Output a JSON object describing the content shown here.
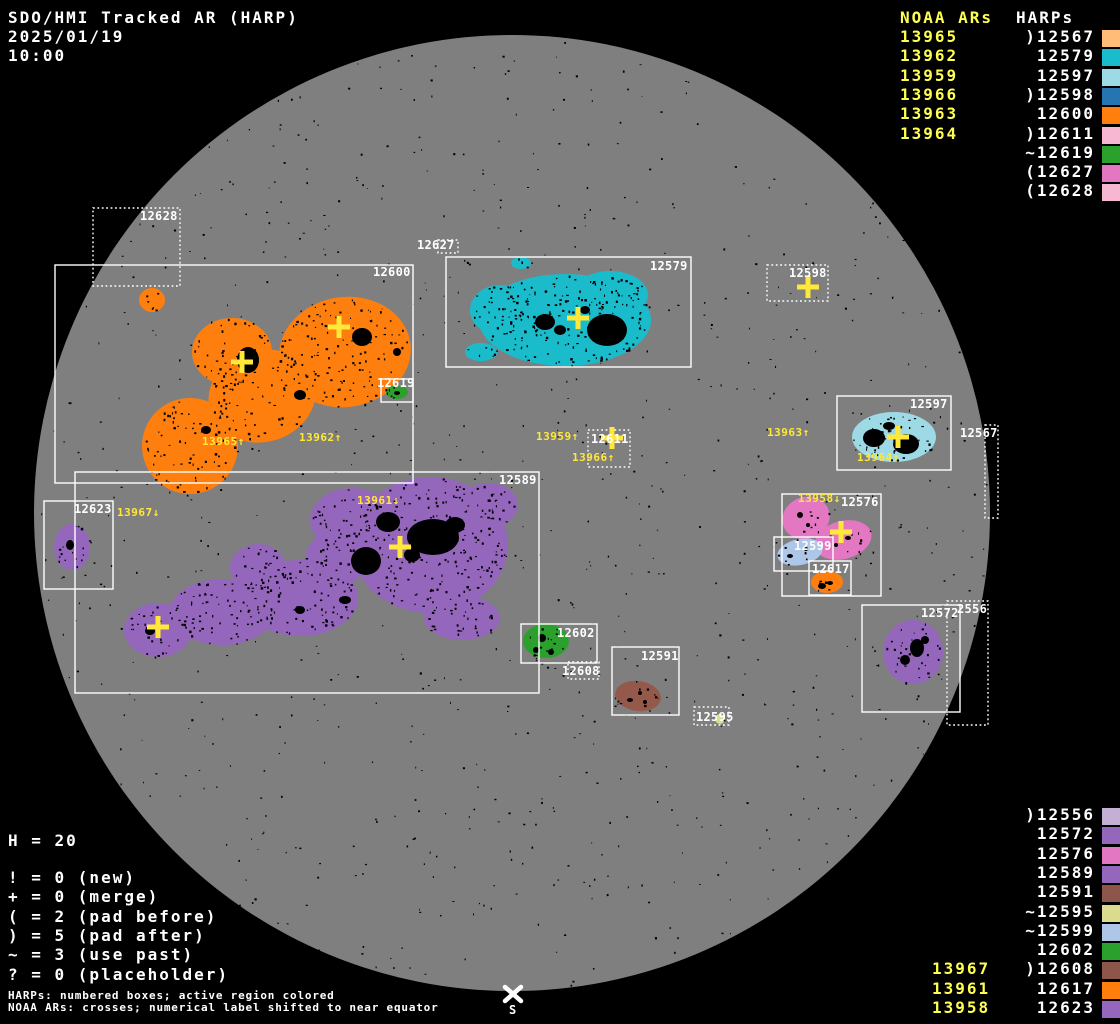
{
  "title": {
    "line1": "SDO/HMI Tracked AR (HARP)",
    "date": "2025/01/19",
    "time": "10:00"
  },
  "colors": {
    "background": "#000000",
    "disk": "#7f7f7f",
    "speckle": "#000000",
    "box_stroke": "#ffffff",
    "noaa_list_text": "#ffff52",
    "noaa_marker": "#ffe83a",
    "white_text": "#ffffff"
  },
  "disk": {
    "cx": 512,
    "cy": 513,
    "r": 478,
    "south_label": "S"
  },
  "top_right_panel": {
    "noaa_header": "NOAA ARs",
    "harps_header": "HARPs",
    "noaa_items": [
      "13965",
      "13962",
      "13959",
      "13966",
      "13963",
      "13964"
    ],
    "harp_items": [
      {
        "prefix": ")",
        "number": "12567",
        "color": "#ffbb78"
      },
      {
        "prefix": " ",
        "number": "12579",
        "color": "#1abccc"
      },
      {
        "prefix": " ",
        "number": "12597",
        "color": "#9edae5"
      },
      {
        "prefix": ")",
        "number": "12598",
        "color": "#2575b2"
      },
      {
        "prefix": " ",
        "number": "12600",
        "color": "#ff7f0e"
      },
      {
        "prefix": ")",
        "number": "12611",
        "color": "#f7b6d2"
      },
      {
        "prefix": "~",
        "number": "12619",
        "color": "#2ca02c"
      },
      {
        "prefix": "(",
        "number": "12627",
        "color": "#e377c2"
      },
      {
        "prefix": "(",
        "number": "12628",
        "color": "#f7b6d2"
      }
    ]
  },
  "bottom_right_panel": {
    "noaa_items": [
      "13967",
      "13961",
      "13958"
    ],
    "harp_items": [
      {
        "prefix": ")",
        "number": "12556",
        "color": "#c5b0d5"
      },
      {
        "prefix": " ",
        "number": "12572",
        "color": "#9467bd"
      },
      {
        "prefix": " ",
        "number": "12576",
        "color": "#e377c2"
      },
      {
        "prefix": " ",
        "number": "12589",
        "color": "#9467bd"
      },
      {
        "prefix": " ",
        "number": "12591",
        "color": "#8c564b"
      },
      {
        "prefix": "~",
        "number": "12595",
        "color": "#dbdb8d"
      },
      {
        "prefix": "~",
        "number": "12599",
        "color": "#aec7e8"
      },
      {
        "prefix": " ",
        "number": "12602",
        "color": "#2ca02c"
      },
      {
        "prefix": ")",
        "number": "12608",
        "color": "#8c564b"
      },
      {
        "prefix": " ",
        "number": "12617",
        "color": "#ff7f0e"
      },
      {
        "prefix": " ",
        "number": "12623",
        "color": "#9467bd"
      }
    ]
  },
  "legend": {
    "h_count": "H = 20",
    "lines": [
      "! = 0 (new)",
      "+ = 0 (merge)",
      "( = 2 (pad before)",
      ") = 5 (pad after)",
      "~ = 3 (use past)",
      "? = 0 (placeholder)"
    ]
  },
  "footer": {
    "line1": "HARPs: numbered boxes; active region colored",
    "line2": "NOAA ARs: crosses; numerical label shifted to near equator"
  },
  "chart_data": {
    "type": "scatter",
    "title": "SDO/HMI Tracked AR (HARP)",
    "datetime": "2025/01/19 10:00",
    "harp_count": 20,
    "harp_boxes": [
      {
        "harp": "12628",
        "label": "12628",
        "style": "dotted",
        "x": 93,
        "y": 208,
        "w": 87,
        "h": 78,
        "label_x": 140,
        "label_y": 210
      },
      {
        "harp": "12600",
        "label": "12600",
        "style": "solid",
        "x": 55,
        "y": 265,
        "w": 358,
        "h": 218,
        "label_x": 373,
        "label_y": 266
      },
      {
        "harp": "12627",
        "label": "12627",
        "style": "dotted",
        "x": 438,
        "y": 240,
        "w": 20,
        "h": 13,
        "label_x": 417,
        "label_y": 239
      },
      {
        "harp": "12579",
        "label": "12579",
        "style": "solid",
        "x": 446,
        "y": 257,
        "w": 245,
        "h": 110,
        "label_x": 650,
        "label_y": 260
      },
      {
        "harp": "12598",
        "label": "12598",
        "style": "dotted",
        "x": 767,
        "y": 265,
        "w": 61,
        "h": 36,
        "label_x": 789,
        "label_y": 267
      },
      {
        "harp": "12619",
        "label": "12619",
        "style": "solid",
        "x": 381,
        "y": 379,
        "w": 32,
        "h": 23,
        "label_x": 377,
        "label_y": 377
      },
      {
        "harp": "12597",
        "label": "12597",
        "style": "solid",
        "x": 837,
        "y": 396,
        "w": 114,
        "h": 74,
        "label_x": 910,
        "label_y": 398
      },
      {
        "harp": "12567",
        "label": "12567",
        "style": "dotted",
        "x": 985,
        "y": 425,
        "w": 13,
        "h": 93,
        "label_x": 960,
        "label_y": 427
      },
      {
        "harp": "12611",
        "label": "12611",
        "style": "dotted",
        "x": 588,
        "y": 430,
        "w": 42,
        "h": 37,
        "label_x": 591,
        "label_y": 433
      },
      {
        "harp": "12589",
        "label": "12589",
        "style": "solid",
        "x": 75,
        "y": 472,
        "w": 464,
        "h": 221,
        "label_x": 499,
        "label_y": 474
      },
      {
        "harp": "12623",
        "label": "12623",
        "style": "solid",
        "x": 44,
        "y": 501,
        "w": 69,
        "h": 88,
        "label_x": 74,
        "label_y": 503
      },
      {
        "harp": "12576",
        "label": "12576",
        "style": "solid",
        "x": 782,
        "y": 494,
        "w": 99,
        "h": 102,
        "label_x": 841,
        "label_y": 496
      },
      {
        "harp": "12599",
        "label": "12599",
        "style": "solid",
        "x": 774,
        "y": 537,
        "w": 59,
        "h": 34,
        "label_x": 794,
        "label_y": 540
      },
      {
        "harp": "12617",
        "label": "12617",
        "style": "solid",
        "x": 809,
        "y": 561,
        "w": 42,
        "h": 34,
        "label_x": 812,
        "label_y": 563
      },
      {
        "harp": "12556",
        "label": "2556",
        "style": "dotted",
        "x": 947,
        "y": 601,
        "w": 41,
        "h": 124,
        "label_x": 957,
        "label_y": 603
      },
      {
        "harp": "12572",
        "label": "12572",
        "style": "solid",
        "x": 862,
        "y": 605,
        "w": 98,
        "h": 107,
        "label_x": 921,
        "label_y": 607
      },
      {
        "harp": "12602",
        "label": "12602",
        "style": "solid",
        "x": 521,
        "y": 624,
        "w": 76,
        "h": 39,
        "label_x": 557,
        "label_y": 627
      },
      {
        "harp": "12591",
        "label": "12591",
        "style": "solid",
        "x": 612,
        "y": 647,
        "w": 67,
        "h": 68,
        "label_x": 641,
        "label_y": 650
      },
      {
        "harp": "12608",
        "label": "12608",
        "style": "dotted",
        "x": 568,
        "y": 662,
        "w": 31,
        "h": 17,
        "label_x": 562,
        "label_y": 665
      },
      {
        "harp": "12595",
        "label": "12595",
        "style": "dotted",
        "x": 694,
        "y": 707,
        "w": 35,
        "h": 18,
        "label_x": 696,
        "label_y": 711
      }
    ],
    "noaa_crosses": [
      {
        "x": 242,
        "y": 362
      },
      {
        "x": 339,
        "y": 327
      },
      {
        "x": 578,
        "y": 318
      },
      {
        "x": 612,
        "y": 438
      },
      {
        "x": 808,
        "y": 287
      },
      {
        "x": 898,
        "y": 437
      },
      {
        "x": 841,
        "y": 532
      },
      {
        "x": 400,
        "y": 547
      },
      {
        "x": 158,
        "y": 627
      }
    ],
    "noaa_labels": [
      {
        "text": "13965↑",
        "x": 202,
        "y": 436
      },
      {
        "text": "13962↑",
        "x": 299,
        "y": 432
      },
      {
        "text": "13959↑",
        "x": 536,
        "y": 431
      },
      {
        "text": "13966↑",
        "x": 572,
        "y": 452
      },
      {
        "text": "13963↑",
        "x": 767,
        "y": 427
      },
      {
        "text": "13964↑",
        "x": 857,
        "y": 452
      },
      {
        "text": "13958↓",
        "x": 798,
        "y": 493
      },
      {
        "text": "13961↓",
        "x": 357,
        "y": 495
      },
      {
        "text": "13967↓",
        "x": 117,
        "y": 507
      }
    ]
  },
  "shapes": [
    {
      "harp": "12600",
      "color": "#ff7f0e",
      "speckles": 300,
      "blobs": [
        {
          "cx": 345,
          "cy": 352,
          "rx": 66,
          "ry": 55,
          "rot": -8
        },
        {
          "cx": 262,
          "cy": 396,
          "rx": 54,
          "ry": 46,
          "rot": -15
        },
        {
          "cx": 190,
          "cy": 446,
          "rx": 48,
          "ry": 48,
          "rot": 0
        },
        {
          "cx": 232,
          "cy": 352,
          "rx": 40,
          "ry": 34,
          "rot": 0
        },
        {
          "cx": 152,
          "cy": 300,
          "rx": 13,
          "ry": 12,
          "rot": 0
        }
      ],
      "spots": [
        {
          "cx": 248,
          "cy": 360,
          "rx": 11,
          "ry": 13
        },
        {
          "cx": 362,
          "cy": 337,
          "rx": 10,
          "ry": 9
        },
        {
          "cx": 300,
          "cy": 395,
          "rx": 6,
          "ry": 5
        },
        {
          "cx": 206,
          "cy": 430,
          "rx": 5,
          "ry": 4
        },
        {
          "cx": 397,
          "cy": 352,
          "rx": 4,
          "ry": 4
        }
      ]
    },
    {
      "harp": "12579",
      "color": "#1abccc",
      "speckles": 240,
      "blobs": [
        {
          "cx": 565,
          "cy": 320,
          "rx": 86,
          "ry": 46,
          "rot": 0
        },
        {
          "cx": 610,
          "cy": 295,
          "rx": 38,
          "ry": 24,
          "rot": 0
        },
        {
          "cx": 500,
          "cy": 310,
          "rx": 30,
          "ry": 25,
          "rot": 0
        },
        {
          "cx": 521,
          "cy": 263,
          "rx": 10,
          "ry": 6,
          "rot": 0
        },
        {
          "cx": 481,
          "cy": 352,
          "rx": 16,
          "ry": 9,
          "rot": 0
        }
      ],
      "spots": [
        {
          "cx": 607,
          "cy": 330,
          "rx": 20,
          "ry": 16
        },
        {
          "cx": 545,
          "cy": 322,
          "rx": 10,
          "ry": 8
        },
        {
          "cx": 560,
          "cy": 330,
          "rx": 6,
          "ry": 5
        },
        {
          "cx": 585,
          "cy": 310,
          "rx": 5,
          "ry": 4
        }
      ]
    },
    {
      "harp": "12597",
      "color": "#9edae5",
      "speckles": 45,
      "blobs": [
        {
          "cx": 894,
          "cy": 437,
          "rx": 42,
          "ry": 25,
          "rot": 0
        }
      ],
      "spots": [
        {
          "cx": 874,
          "cy": 438,
          "rx": 11,
          "ry": 9
        },
        {
          "cx": 906,
          "cy": 444,
          "rx": 13,
          "ry": 10
        },
        {
          "cx": 889,
          "cy": 426,
          "rx": 6,
          "ry": 4
        }
      ]
    },
    {
      "harp": "12589",
      "color": "#9467bd",
      "speckles": 520,
      "blobs": [
        {
          "cx": 430,
          "cy": 545,
          "rx": 78,
          "ry": 68,
          "rot": 0
        },
        {
          "cx": 352,
          "cy": 520,
          "rx": 42,
          "ry": 32,
          "rot": 0
        },
        {
          "cx": 300,
          "cy": 598,
          "rx": 58,
          "ry": 38,
          "rot": 0
        },
        {
          "cx": 222,
          "cy": 612,
          "rx": 52,
          "ry": 33,
          "rot": 0
        },
        {
          "cx": 158,
          "cy": 630,
          "rx": 34,
          "ry": 27,
          "rot": 0
        },
        {
          "cx": 258,
          "cy": 568,
          "rx": 28,
          "ry": 24,
          "rot": 0
        },
        {
          "cx": 462,
          "cy": 618,
          "rx": 38,
          "ry": 22,
          "rot": 0
        },
        {
          "cx": 335,
          "cy": 560,
          "rx": 30,
          "ry": 28,
          "rot": 0
        },
        {
          "cx": 488,
          "cy": 505,
          "rx": 30,
          "ry": 22,
          "rot": 0
        }
      ],
      "spots": [
        {
          "cx": 433,
          "cy": 537,
          "rx": 26,
          "ry": 18
        },
        {
          "cx": 366,
          "cy": 561,
          "rx": 15,
          "ry": 14
        },
        {
          "cx": 388,
          "cy": 522,
          "rx": 12,
          "ry": 10
        },
        {
          "cx": 455,
          "cy": 525,
          "rx": 10,
          "ry": 8
        },
        {
          "cx": 412,
          "cy": 555,
          "rx": 8,
          "ry": 7
        },
        {
          "cx": 150,
          "cy": 631,
          "rx": 5,
          "ry": 4
        },
        {
          "cx": 345,
          "cy": 600,
          "rx": 6,
          "ry": 4
        },
        {
          "cx": 300,
          "cy": 610,
          "rx": 5,
          "ry": 4
        }
      ]
    },
    {
      "harp": "12623",
      "color": "#9467bd",
      "speckles": 14,
      "blobs": [
        {
          "cx": 72,
          "cy": 547,
          "rx": 18,
          "ry": 23,
          "rot": 0
        }
      ],
      "spots": [
        {
          "cx": 70,
          "cy": 545,
          "rx": 4,
          "ry": 5
        }
      ]
    },
    {
      "harp": "12572",
      "color": "#9467bd",
      "speckles": 25,
      "blobs": [
        {
          "cx": 913,
          "cy": 652,
          "rx": 30,
          "ry": 32,
          "rot": 0
        }
      ],
      "spots": [
        {
          "cx": 917,
          "cy": 648,
          "rx": 7,
          "ry": 9
        },
        {
          "cx": 905,
          "cy": 660,
          "rx": 5,
          "ry": 5
        },
        {
          "cx": 925,
          "cy": 640,
          "rx": 4,
          "ry": 4
        }
      ]
    },
    {
      "harp": "12619",
      "color": "#2ca02c",
      "speckles": 4,
      "blobs": [
        {
          "cx": 397,
          "cy": 392,
          "rx": 11,
          "ry": 7,
          "rot": 0
        }
      ],
      "spots": [
        {
          "cx": 397,
          "cy": 393,
          "rx": 3,
          "ry": 2
        }
      ]
    },
    {
      "harp": "12602",
      "color": "#2ca02c",
      "speckles": 12,
      "blobs": [
        {
          "cx": 546,
          "cy": 641,
          "rx": 23,
          "ry": 17,
          "rot": 0
        }
      ],
      "spots": [
        {
          "cx": 542,
          "cy": 638,
          "rx": 4,
          "ry": 4
        },
        {
          "cx": 551,
          "cy": 652,
          "rx": 3,
          "ry": 3
        },
        {
          "cx": 536,
          "cy": 650,
          "rx": 3,
          "ry": 3
        }
      ]
    },
    {
      "harp": "12576",
      "color": "#e377c2",
      "speckles": 14,
      "blobs": [
        {
          "cx": 806,
          "cy": 518,
          "rx": 24,
          "ry": 21,
          "rot": -20
        },
        {
          "cx": 843,
          "cy": 540,
          "rx": 29,
          "ry": 19,
          "rot": -15
        }
      ],
      "spots": [
        {
          "cx": 800,
          "cy": 515,
          "rx": 3,
          "ry": 3
        },
        {
          "cx": 808,
          "cy": 525,
          "rx": 2,
          "ry": 2
        },
        {
          "cx": 848,
          "cy": 538,
          "rx": 3,
          "ry": 2
        },
        {
          "cx": 836,
          "cy": 545,
          "rx": 2,
          "ry": 2
        }
      ]
    },
    {
      "harp": "12599",
      "color": "#aec7e8",
      "speckles": 6,
      "blobs": [
        {
          "cx": 800,
          "cy": 552,
          "rx": 23,
          "ry": 13,
          "rot": -12
        }
      ],
      "spots": [
        {
          "cx": 790,
          "cy": 556,
          "rx": 3,
          "ry": 2
        },
        {
          "cx": 806,
          "cy": 549,
          "rx": 2,
          "ry": 2
        }
      ]
    },
    {
      "harp": "12617",
      "color": "#ff7f0e",
      "speckles": 5,
      "blobs": [
        {
          "cx": 827,
          "cy": 582,
          "rx": 16,
          "ry": 11,
          "rot": 0
        }
      ],
      "spots": [
        {
          "cx": 822,
          "cy": 586,
          "rx": 4,
          "ry": 3
        },
        {
          "cx": 830,
          "cy": 583,
          "rx": 3,
          "ry": 2
        }
      ]
    },
    {
      "harp": "12591",
      "color": "#95594c",
      "speckles": 8,
      "blobs": [
        {
          "cx": 638,
          "cy": 696,
          "rx": 23,
          "ry": 15,
          "rot": 8
        }
      ],
      "spots": [
        {
          "cx": 630,
          "cy": 700,
          "rx": 3,
          "ry": 2
        },
        {
          "cx": 640,
          "cy": 693,
          "rx": 2,
          "ry": 2
        },
        {
          "cx": 645,
          "cy": 702,
          "rx": 2,
          "ry": 2
        }
      ]
    },
    {
      "harp": "12595",
      "color": "#dbdb8d",
      "speckles": 2,
      "blobs": [
        {
          "cx": 720,
          "cy": 719,
          "rx": 5,
          "ry": 5,
          "rot": 0
        }
      ],
      "spots": []
    }
  ]
}
